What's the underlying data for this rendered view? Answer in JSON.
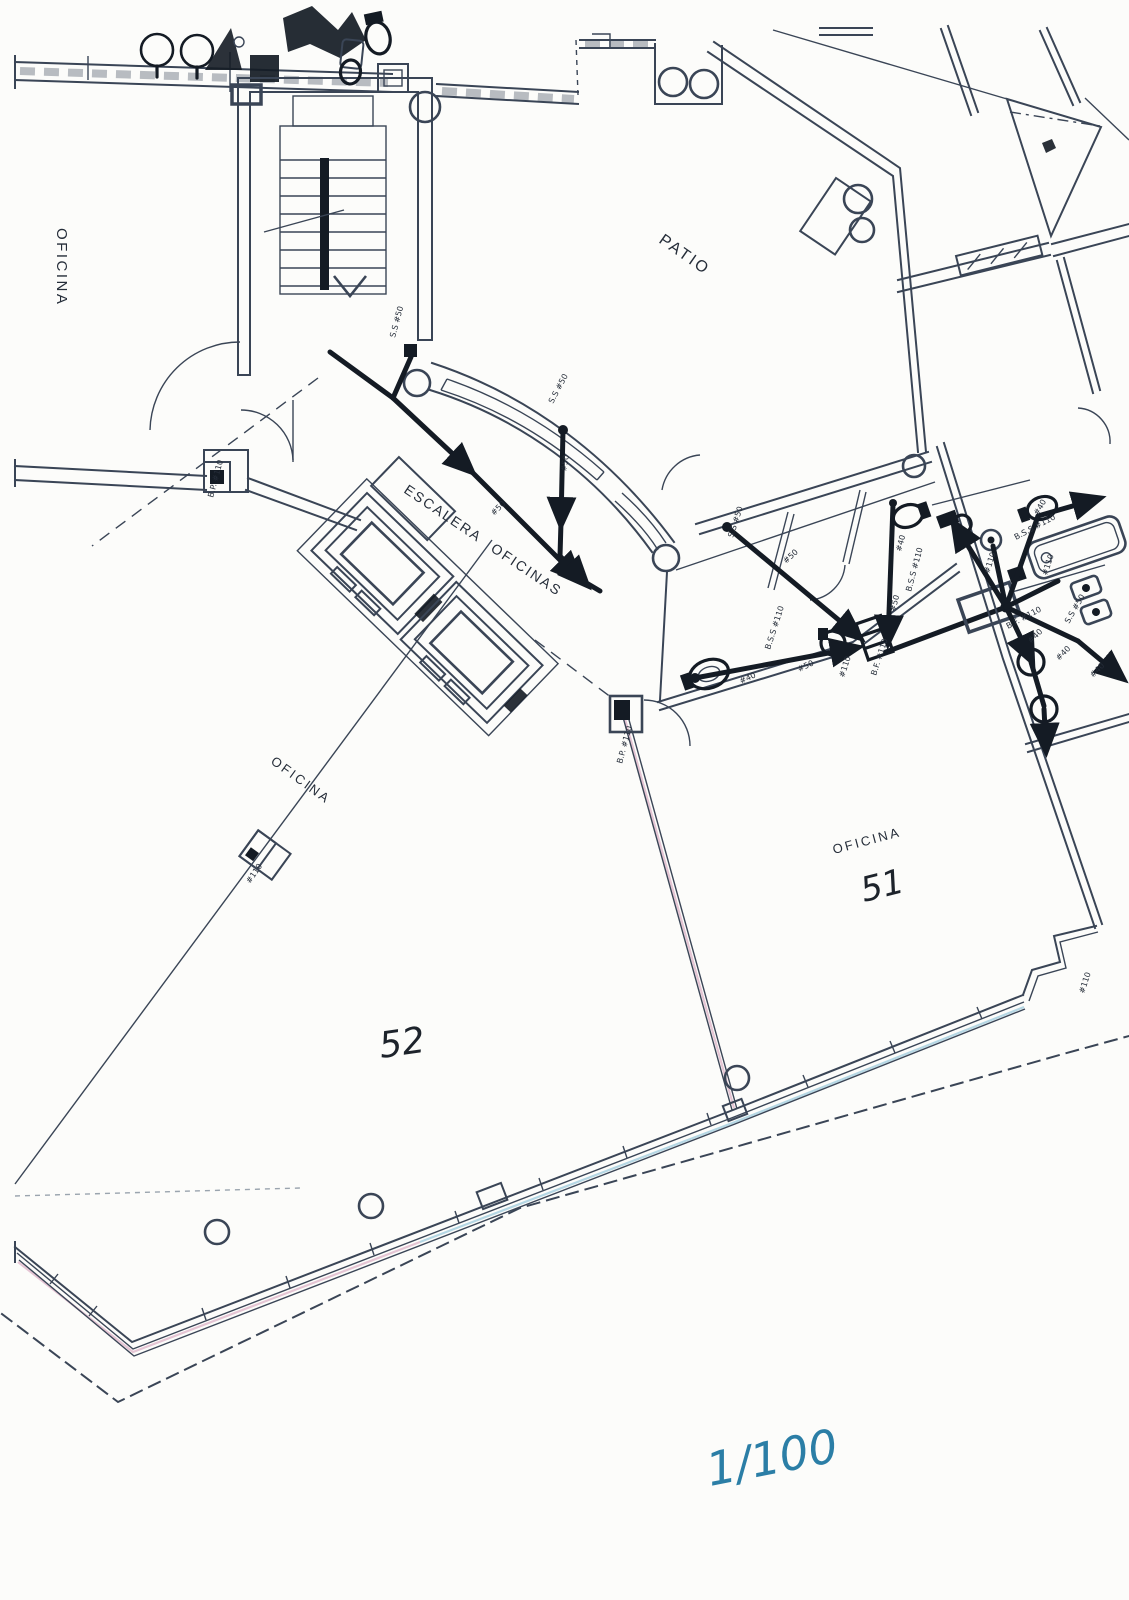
{
  "colors": {
    "paper": "#fcfcfa",
    "ink": "#3a4556",
    "pipe": "#141b24",
    "annotation": "#252d39",
    "scale_blue": "#2b7ea6",
    "tint_pink": "#d9a8c0",
    "tint_cyan": "#8fc3d9",
    "faint": "#9aa4ae"
  },
  "labels": {
    "office_left": "OFICINA",
    "patio": "PATIO",
    "corridor": "ESCALERA OFICINAS",
    "office_mid": "OFICINA",
    "office51_name": "OFICINA",
    "office51_no": "51",
    "office52_no": "52",
    "scale_note": "1/100"
  },
  "pipe_annotations": [
    {
      "text": "S.S #50"
    },
    {
      "text": "S.S #50"
    },
    {
      "text": "#50"
    },
    {
      "text": "#50"
    },
    {
      "text": "S.S #50"
    },
    {
      "text": "#50"
    },
    {
      "text": "#40"
    },
    {
      "text": "B.S.S #110"
    },
    {
      "text": "#50"
    },
    {
      "text": "B.S.S #110"
    },
    {
      "text": "#50"
    },
    {
      "text": "#40"
    },
    {
      "text": "#110"
    },
    {
      "text": "B.F. #110"
    },
    {
      "text": "B.P. #110"
    },
    {
      "text": "B.P. #110"
    },
    {
      "text": "#110"
    },
    {
      "text": "#40"
    },
    {
      "text": "B.S.S #110"
    },
    {
      "text": "#110"
    },
    {
      "text": "#110"
    },
    {
      "text": "B.F. #110"
    },
    {
      "text": "S.S #50"
    },
    {
      "text": "#40"
    },
    {
      "text": "#40"
    },
    {
      "text": "#40"
    },
    {
      "text": "#110"
    }
  ]
}
